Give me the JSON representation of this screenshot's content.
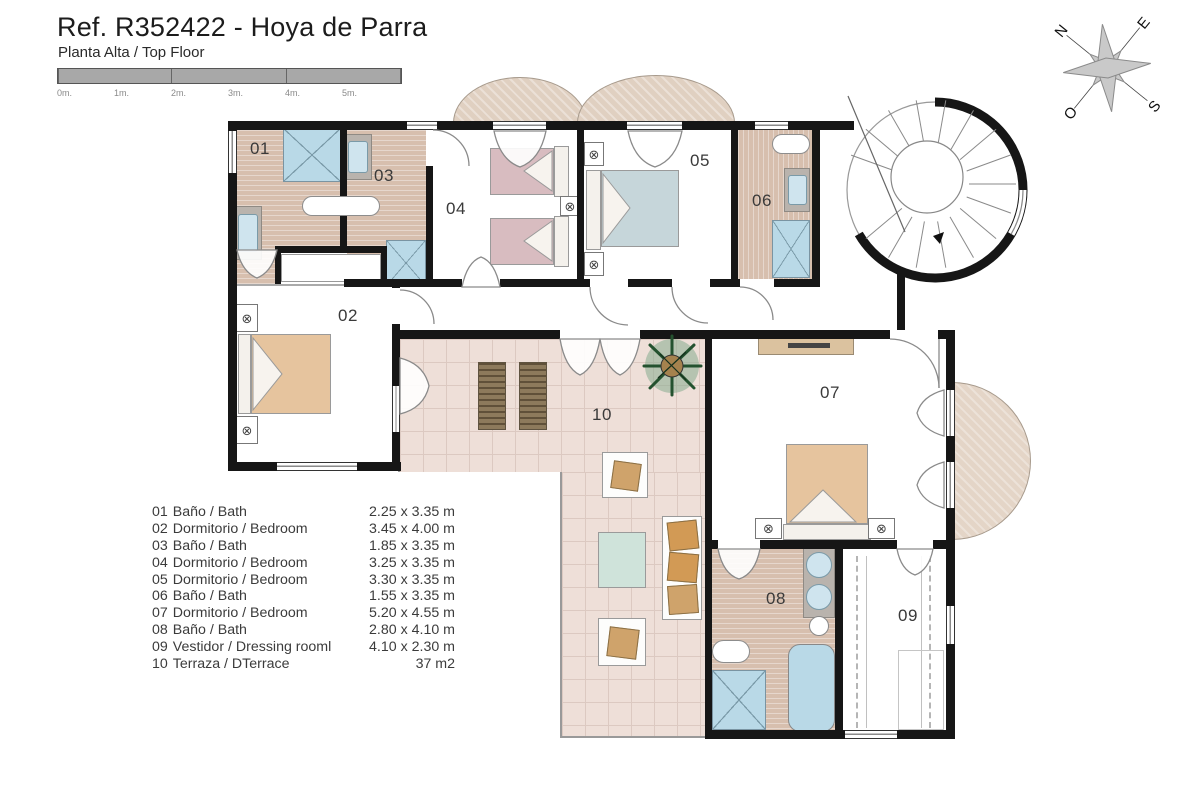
{
  "header": {
    "title": "Ref. R352422 - Hoya de Parra",
    "subtitle": "Planta Alta / Top Floor"
  },
  "scale_bar": {
    "labels": [
      "0m.",
      "1m.",
      "2m.",
      "3m.",
      "4m.",
      "5m."
    ]
  },
  "compass": {
    "n": "N",
    "e": "E",
    "s": "S",
    "o": "O"
  },
  "rooms": [
    {
      "num": "01",
      "name": "Baño / Bath",
      "dims": "2.25 x 3.35 m"
    },
    {
      "num": "02",
      "name": "Dormitorio / Bedroom",
      "dims": "3.45 x 4.00 m"
    },
    {
      "num": "03",
      "name": "Baño / Bath",
      "dims": "1.85 x 3.35 m"
    },
    {
      "num": "04",
      "name": "Dormitorio / Bedroom",
      "dims": "3.25 x 3.35 m"
    },
    {
      "num": "05",
      "name": "Dormitorio / Bedroom",
      "dims": "3.30 x 3.35 m"
    },
    {
      "num": "06",
      "name": "Baño / Bath",
      "dims": "1.55 x 3.35 m"
    },
    {
      "num": "07",
      "name": "Dormitorio / Bedroom",
      "dims": "5.20 x 4.55 m"
    },
    {
      "num": "08",
      "name": "Baño / Bath",
      "dims": "2.80 x 4.10 m"
    },
    {
      "num": "09",
      "name": "Vestidor / Dressing rooml",
      "dims": "4.10 x 2.30 m"
    },
    {
      "num": "10",
      "name": "Terraza / DTerrace",
      "dims": "37 m2"
    }
  ],
  "icons": {
    "lamp": "⊗"
  },
  "colors": {
    "wall": "#161616",
    "bath_floor": "#d7bfae",
    "terrace_tile": "#eedfd8",
    "fixture_blue": "#b9d9e7",
    "bed_pink": "#d8bcc0",
    "bed_blue": "#c6d6da",
    "bed_tan": "#e6c49e",
    "lounger_brown": "#8d7a5c",
    "plant_green": "#2e5d3e"
  }
}
